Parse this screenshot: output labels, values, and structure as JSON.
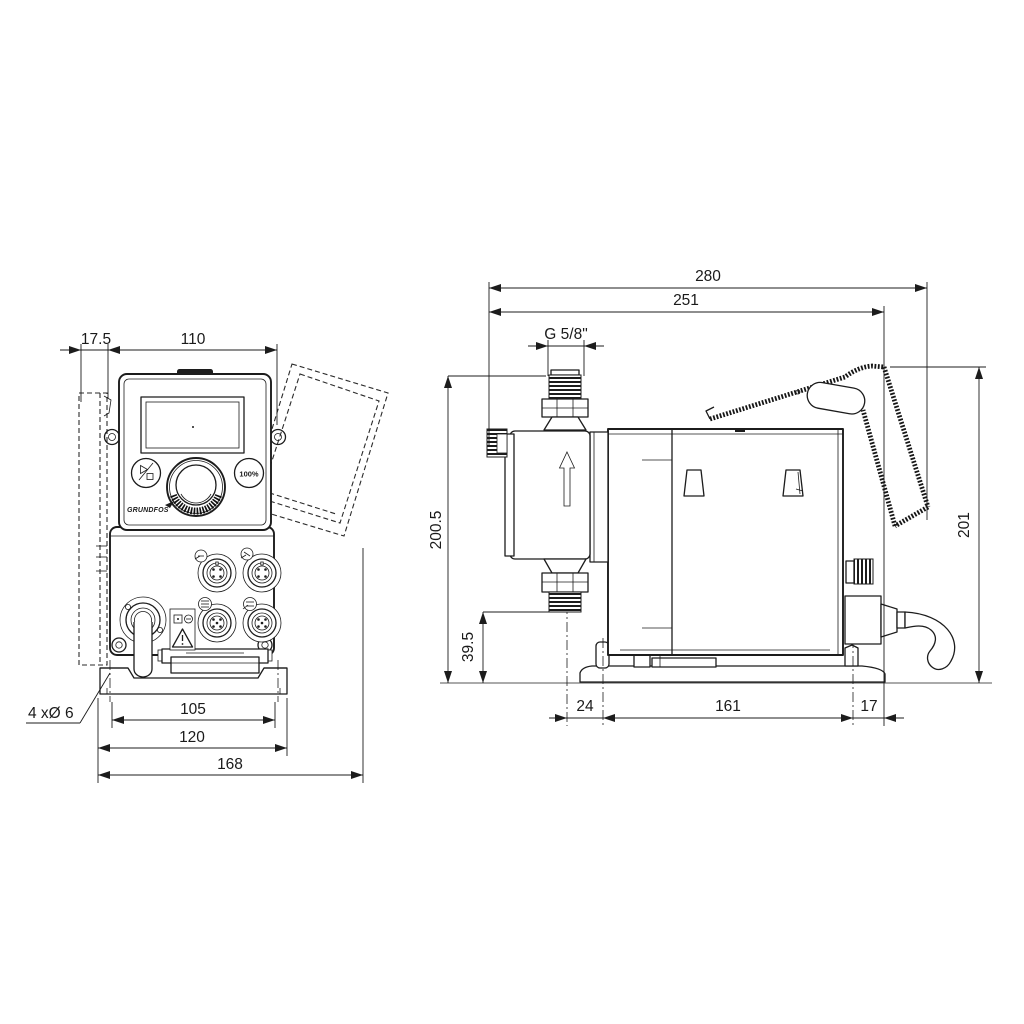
{
  "drawing": {
    "front_view": {
      "dims": {
        "wall_plate_depth": "17.5",
        "body_width": "110",
        "hole_spacing": "105",
        "plate_width": "120",
        "overall_width": "168",
        "hole_note": "4 xØ 6"
      },
      "panel": {
        "button_100_percent": "100%",
        "logo": "GRUNDFOS"
      }
    },
    "side_view": {
      "dims": {
        "overall_length": "280",
        "length_to_plate_edge": "251",
        "thread_size": "G 5/8\"",
        "height_to_inlet": "200.5",
        "outlet_height": "39.5",
        "overall_height": "201",
        "outlet_to_hole": "24",
        "foot_hole_spacing": "161",
        "foot_edge": "17"
      }
    },
    "colors": {
      "line": "#1c1c1c",
      "background": "#ffffff"
    }
  }
}
